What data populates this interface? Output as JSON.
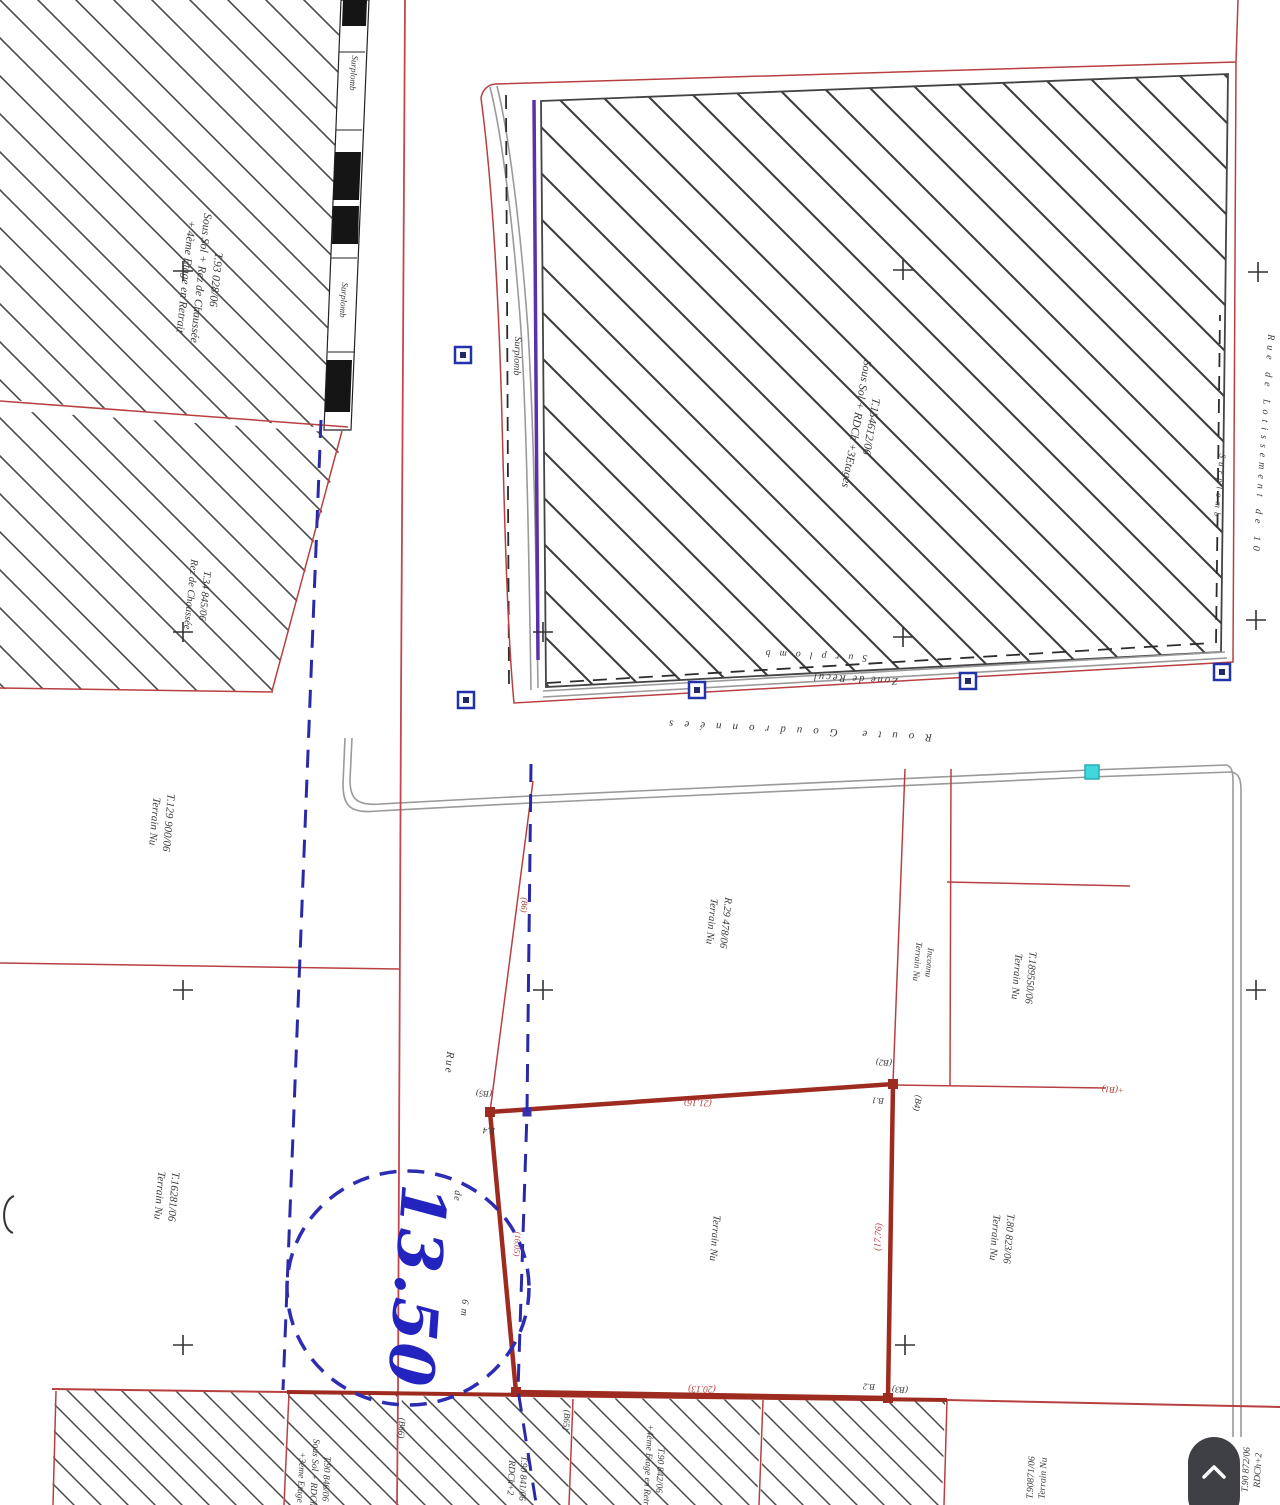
{
  "document": {
    "type": "cadastral-survey-plan",
    "colors": {
      "red_boundary": "#b84040",
      "pink_line": "#c2484e",
      "dark_red_parcel": "#9e2b20",
      "blue_dashed": "#2a2aa8",
      "stamp_blue": "#2324c0",
      "purple_line": "#5a31a8",
      "road_gray": "#9a9a9a",
      "hatch_gray": "#4a4a4a",
      "marker_blue": "#2233aa",
      "marker_cyan": "#3fd8dd",
      "button_bg": "#3f4045"
    }
  },
  "map": {
    "labels": [
      {
        "name": "parcel-tl-label",
        "x": 200,
        "y": 278,
        "rot": 96,
        "size": 11.5,
        "ls": 0,
        "color": "#3a3a3a",
        "bold": false,
        "lines": [
          "T.93 028/06",
          "Sous Sol + Rez de Chaussée",
          "+ 4ème Etage en Retrait"
        ]
      },
      {
        "name": "parcel-tl2-label",
        "x": 197,
        "y": 595,
        "rot": 96,
        "size": 10.5,
        "ls": 0,
        "color": "#3a3a3a",
        "bold": false,
        "lines": [
          "T.34 845/06",
          "Rez de Chaussée"
        ]
      },
      {
        "name": "parcel-main-label",
        "x": 863,
        "y": 425,
        "rot": 100,
        "size": 11.5,
        "ls": 0,
        "color": "#3a3a3a",
        "bold": false,
        "lines": [
          "T.154612/06",
          "Sous Sol + RDCh +3Etages"
        ]
      },
      {
        "name": "street-rue-lotissement-label",
        "x": 1263,
        "y": 445,
        "rot": 94,
        "size": 10,
        "ls": 5,
        "color": "#3a3a3a",
        "bold": false,
        "lines": [
          "Rue de Lotissement de 10"
        ]
      },
      {
        "name": "surplomb-right-label",
        "x": 1219,
        "y": 487,
        "rot": 95,
        "size": 9,
        "ls": 4,
        "color": "#3a3a3a",
        "bold": false,
        "lines": [
          "Surplomb"
        ]
      },
      {
        "name": "surplomb-road-label",
        "x": 812,
        "y": 655,
        "rot": 183,
        "size": 10,
        "ls": 9,
        "color": "#3a3a3a",
        "bold": false,
        "lines": [
          "Surplomb"
        ]
      },
      {
        "name": "zone-de-recul-label",
        "x": 855,
        "y": 678,
        "rot": 183,
        "size": 10.5,
        "ls": 2,
        "color": "#3a3a3a",
        "bold": false,
        "lines": [
          "Zone de Recul"
        ]
      },
      {
        "name": "route-goudronnees-label",
        "x": 795,
        "y": 730,
        "rot": 183,
        "size": 11,
        "ls": 11,
        "color": "#3a3a3a",
        "bold": false,
        "lines": [
          "Route  Goudronnées"
        ]
      },
      {
        "name": "surplomb-band1-label",
        "x": 353,
        "y": 73,
        "rot": 94,
        "size": 9,
        "ls": 0,
        "color": "#3a3a3a",
        "bold": false,
        "lines": [
          "Surplomb"
        ]
      },
      {
        "name": "surplomb-band2-label",
        "x": 343,
        "y": 300,
        "rot": 94,
        "size": 9,
        "ls": 0,
        "color": "#3a3a3a",
        "bold": false,
        "lines": [
          "Surplomb"
        ]
      },
      {
        "name": "surplomb-street-label",
        "x": 517,
        "y": 356,
        "rot": 92,
        "size": 10,
        "ls": 0,
        "color": "#3a3a3a",
        "bold": false,
        "lines": [
          "Surplomb"
        ]
      },
      {
        "name": "parcel-t129-label",
        "x": 161,
        "y": 822,
        "rot": 95,
        "size": 11,
        "ls": 0,
        "color": "#3a3a3a",
        "bold": false,
        "lines": [
          "T.129 900/06",
          "Terrain Nu"
        ]
      },
      {
        "name": "parcel-t162-label",
        "x": 166,
        "y": 1196,
        "rot": 95,
        "size": 11,
        "ls": 0,
        "color": "#3a3a3a",
        "bold": false,
        "lines": [
          "T.16281/06",
          "Terrain Nu"
        ]
      },
      {
        "name": "parcel-r29-label",
        "x": 718,
        "y": 922,
        "rot": 96,
        "size": 10.5,
        "ls": 0,
        "color": "#3a3a3a",
        "bold": false,
        "lines": [
          "R.29 478/06",
          "Terrain Nu"
        ]
      },
      {
        "name": "parcel-inconnu-label",
        "x": 923,
        "y": 962,
        "rot": 95,
        "size": 9,
        "ls": 0,
        "color": "#3a3a3a",
        "bold": false,
        "lines": [
          "Inconnu",
          "Terrain Nu"
        ]
      },
      {
        "name": "parcel-t189-label",
        "x": 1023,
        "y": 977,
        "rot": 95,
        "size": 10.5,
        "ls": 0,
        "color": "#3a3a3a",
        "bold": false,
        "lines": [
          "T.189550/06",
          "Terrain Nu"
        ]
      },
      {
        "name": "parcel-t80-label",
        "x": 1001,
        "y": 1238,
        "rot": 95,
        "size": 10.5,
        "ls": 0,
        "color": "#3a3a3a",
        "bold": false,
        "lines": [
          "T.80 823/06",
          "Terrain Nu"
        ]
      },
      {
        "name": "parcel-subject-label",
        "x": 714,
        "y": 1238,
        "rot": 95,
        "size": 10.5,
        "ls": 0,
        "color": "#3a3a3a",
        "bold": false,
        "lines": [
          "Terrain Nu"
        ]
      },
      {
        "name": "street-rue-label",
        "x": 449,
        "y": 1063,
        "rot": 95,
        "size": 11,
        "ls": 2,
        "color": "#3a3a3a",
        "bold": false,
        "lines": [
          "Rue"
        ]
      },
      {
        "name": "street-de-label",
        "x": 457,
        "y": 1196,
        "rot": 95,
        "size": 10,
        "ls": 1,
        "color": "#3a3a3a",
        "bold": false,
        "lines": [
          "de"
        ]
      },
      {
        "name": "street-6m-label",
        "x": 464,
        "y": 1308,
        "rot": 95,
        "size": 10,
        "ls": 1,
        "color": "#3a3a3a",
        "bold": false,
        "lines": [
          "6 m"
        ]
      },
      {
        "name": "width-stamp-value",
        "x": 416,
        "y": 1286,
        "rot": 94,
        "size": 62,
        "ls": 2,
        "color": "#2324c0",
        "bold": true,
        "lines": [
          "13.50"
        ]
      },
      {
        "name": "dim-top-label",
        "x": 698,
        "y": 1102,
        "rot": 182,
        "size": 9.5,
        "ls": 0,
        "color": "#b84040",
        "bold": false,
        "lines": [
          "(21.16)"
        ]
      },
      {
        "name": "dim-bottom-label",
        "x": 702,
        "y": 1388,
        "rot": 181,
        "size": 9.5,
        "ls": 0,
        "color": "#b84040",
        "bold": false,
        "lines": [
          "(20.13)"
        ]
      },
      {
        "name": "dim-right-label",
        "x": 879,
        "y": 1237,
        "rot": -86,
        "size": 9.5,
        "ls": 0,
        "color": "#b84040",
        "bold": false,
        "lines": [
          "(17.76)"
        ]
      },
      {
        "name": "dim-street-label",
        "x": 517,
        "y": 1244,
        "rot": 93,
        "size": 8.5,
        "ls": 0,
        "color": "#c2484e",
        "bold": false,
        "lines": [
          "(16.05)"
        ]
      },
      {
        "name": "vertex-code-b5",
        "x": 484,
        "y": 1093,
        "rot": 184,
        "size": 9,
        "ls": 0,
        "color": "#3a3a3a",
        "bold": false,
        "lines": [
          "(B5)"
        ]
      },
      {
        "name": "vertex-name-b4",
        "x": 489,
        "y": 1130,
        "rot": 184,
        "size": 9,
        "ls": 0,
        "color": "#3a3a3a",
        "bold": false,
        "lines": [
          "B.4"
        ]
      },
      {
        "name": "vertex-code-b2",
        "x": 884,
        "y": 1062,
        "rot": 184,
        "size": 9,
        "ls": 0,
        "color": "#3a3a3a",
        "bold": false,
        "lines": [
          "(B2)"
        ]
      },
      {
        "name": "vertex-name-b1",
        "x": 878,
        "y": 1100,
        "rot": 184,
        "size": 9,
        "ls": 0,
        "color": "#3a3a3a",
        "bold": false,
        "lines": [
          "B.1"
        ]
      },
      {
        "name": "vertex-code-b4",
        "x": 917,
        "y": 1103,
        "rot": 100,
        "size": 9,
        "ls": 0,
        "color": "#3a3a3a",
        "bold": false,
        "lines": [
          "(B4)"
        ]
      },
      {
        "name": "vertex-name-b2",
        "x": 869,
        "y": 1386,
        "rot": 183,
        "size": 9,
        "ls": 0,
        "color": "#3a3a3a",
        "bold": false,
        "lines": [
          "B.2"
        ]
      },
      {
        "name": "vertex-code-b3",
        "x": 900,
        "y": 1389,
        "rot": 183,
        "size": 9,
        "ls": 0,
        "color": "#3a3a3a",
        "bold": false,
        "lines": [
          "(B3)"
        ]
      },
      {
        "name": "vertex-code-b1-far",
        "x": 1113,
        "y": 1089,
        "rot": 183,
        "size": 9,
        "ls": 0,
        "color": "#a33a33",
        "bold": false,
        "lines": [
          "+(B1)"
        ]
      },
      {
        "name": "vertex-code-b6",
        "x": 524,
        "y": 905,
        "rot": 94,
        "size": 8.5,
        "ls": 0,
        "color": "#a33a33",
        "bold": false,
        "lines": [
          "(B6)"
        ]
      },
      {
        "name": "vertex-code-b66",
        "x": 401,
        "y": 1428,
        "rot": 94,
        "size": 9,
        "ls": 0,
        "color": "#3a3a3a",
        "bold": false,
        "lines": [
          "(B66)"
        ]
      },
      {
        "name": "vertex-code-b65",
        "x": 566,
        "y": 1420,
        "rot": 94,
        "size": 9,
        "ls": 0,
        "color": "#3a3a3a",
        "bold": false,
        "lines": [
          "(B65)"
        ]
      },
      {
        "name": "parcel-bottom-b-label",
        "x": 313,
        "y": 1478,
        "rot": 93,
        "size": 9.5,
        "ls": 0,
        "color": "#3a3a3a",
        "bold": false,
        "lines": [
          "T.90 846/06",
          "Sous Sol + RDCh+2",
          "+3ème Etage"
        ]
      },
      {
        "name": "parcel-bottom-c-label",
        "x": 516,
        "y": 1478,
        "rot": 93,
        "size": 9.5,
        "ls": 0,
        "color": "#3a3a3a",
        "bold": false,
        "lines": [
          "T.90 841/06",
          "RDCh+2"
        ]
      },
      {
        "name": "parcel-bottom-d-label",
        "x": 653,
        "y": 1470,
        "rot": 93,
        "size": 9.5,
        "ls": 0,
        "color": "#3a3a3a",
        "bold": false,
        "lines": [
          "T.90 842/06",
          "+4ème Etage en Retrait"
        ]
      },
      {
        "name": "parcel-bottom-f1-label",
        "x": 1038,
        "y": 1478,
        "rot": -87,
        "size": 9.5,
        "ls": 0,
        "color": "#3a3a3a",
        "bold": false,
        "lines": [
          "T.90871/06",
          "Terrain Nu"
        ]
      },
      {
        "name": "parcel-bottom-f2-label",
        "x": 1253,
        "y": 1470,
        "rot": -87,
        "size": 9.5,
        "ls": 0,
        "color": "#3a3a3a",
        "bold": false,
        "lines": [
          "T.90 872/06",
          "RDCh+2"
        ]
      }
    ]
  },
  "ui": {
    "scroll_top_button": {
      "icon": "chevron-up-icon"
    }
  }
}
